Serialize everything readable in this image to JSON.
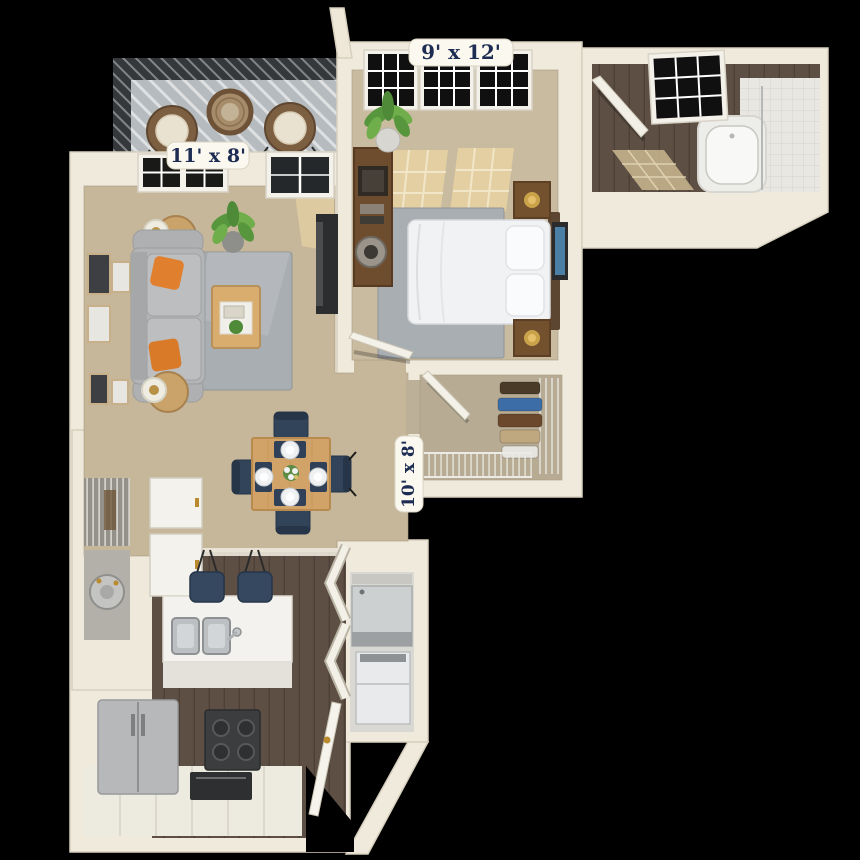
{
  "title": "Apartment 3D floor plan render",
  "labels": {
    "bedroom": "9' x 12'",
    "balcony": "11' x 8'",
    "dining": "10' x 8'"
  },
  "rooms": [
    {
      "name": "Balcony",
      "dimensions": "11' x 8'",
      "furniture": [
        "wicker chair",
        "wicker chair",
        "round wicker table"
      ]
    },
    {
      "name": "Living Room",
      "dimensions": null,
      "furniture": [
        "sofa",
        "orange throw pillows",
        "area rug",
        "coffee table",
        "side table with lamp",
        "side table with lamp",
        "potted plant",
        "tv stand",
        "gallery wall frames",
        "windows",
        "balcony glass door"
      ]
    },
    {
      "name": "Dining Area",
      "dimensions": "10' x 8'",
      "furniture": [
        "square dining table",
        "dining chair",
        "dining chair",
        "dining chair",
        "dining chair",
        "place settings",
        "floral centerpiece"
      ]
    },
    {
      "name": "Kitchen",
      "dimensions": null,
      "furniture": [
        "island with double sink",
        "bar stool",
        "bar stool",
        "refrigerator",
        "range with oven",
        "white cabinets",
        "pantry with wire shelves",
        "water heater closet"
      ]
    },
    {
      "name": "Bedroom",
      "dimensions": "9' x 12'",
      "furniture": [
        "bed",
        "pillows",
        "headboard",
        "nightstand",
        "nightstand",
        "gold lamps",
        "dresser",
        "decor bowl",
        "potted plant",
        "area rug",
        "wall art",
        "windows"
      ]
    },
    {
      "name": "Bathroom",
      "dimensions": null,
      "furniture": [
        "bathtub with shower",
        "tile surround",
        "shower rod",
        "window",
        "door"
      ]
    },
    {
      "name": "Walk-in Closet",
      "dimensions": null,
      "furniture": [
        "wire shelving",
        "hanging clothes",
        "door"
      ]
    },
    {
      "name": "Laundry Closet",
      "dimensions": null,
      "furniture": [
        "washer",
        "dryer",
        "bifold doors"
      ]
    },
    {
      "name": "Entry",
      "dimensions": null,
      "furniture": [
        "open front door"
      ]
    }
  ],
  "colors": {
    "background": "#000000",
    "wall": "#f0eadc",
    "wall_edge": "#d7d0be",
    "carpet": "#c6b79b",
    "carpet_closet": "#b7ab93",
    "sun_patch": "#e7d2a2",
    "dark_wood_floor": "#5d4f44",
    "rug_gray": "#a9aeb2",
    "sofa_gray": "#b2b4b6",
    "accent_orange": "#e0802f",
    "navy_chair": "#324459",
    "table_wood": "#d2a368",
    "label_text_navy": "#1d2c52",
    "label_pill": "#fbf8f0",
    "stainless": "#b6b8ba",
    "appliance_dark": "#3c3d3f"
  }
}
